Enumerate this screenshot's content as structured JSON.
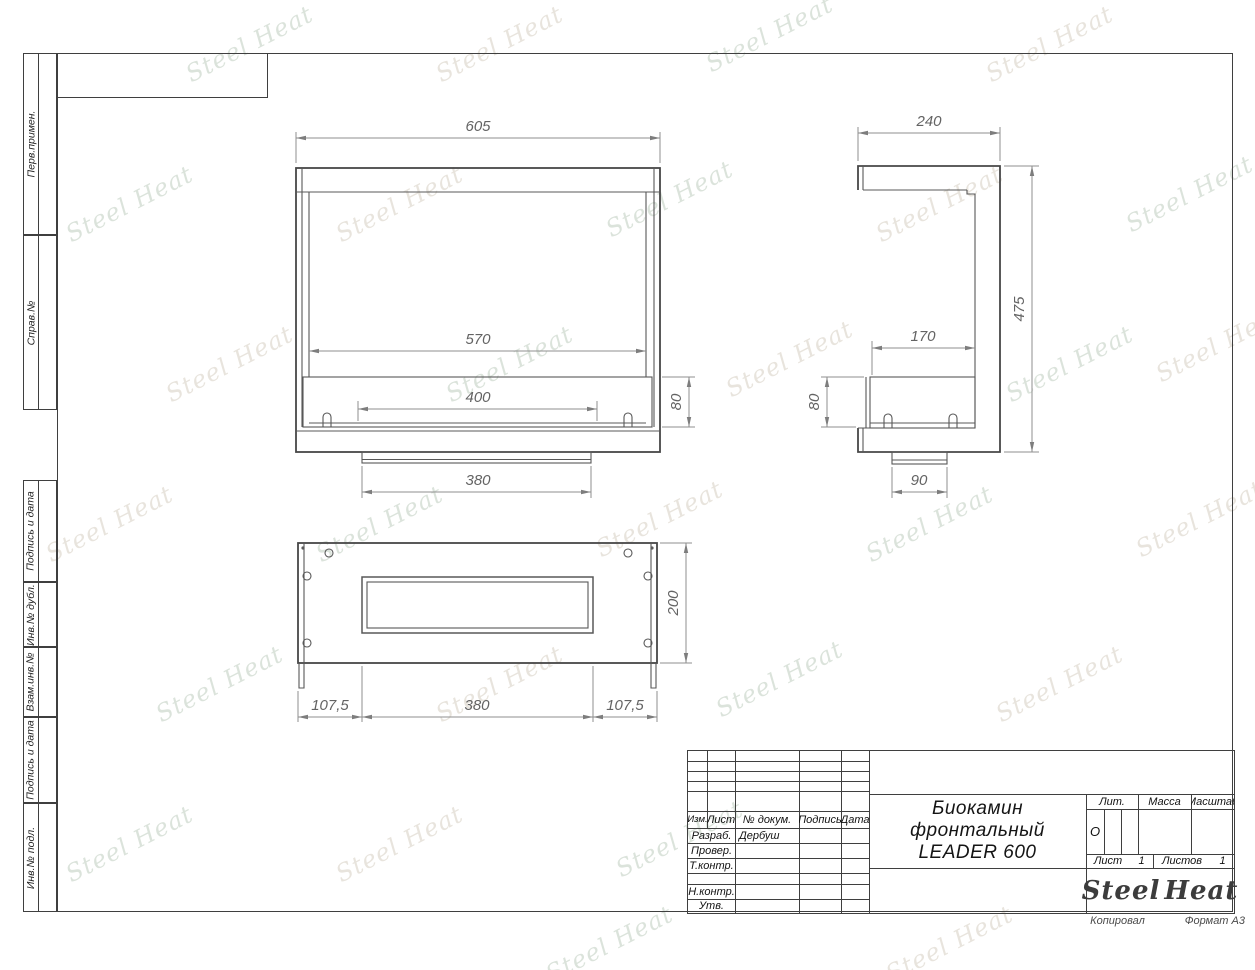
{
  "watermark": {
    "text": "Steel Heat"
  },
  "side_strip": {
    "boxes": [
      {
        "label": "Перв.примен."
      },
      {
        "label": "Справ.№"
      },
      {
        "label": "Подпись и дата"
      },
      {
        "label": "Инв.№ дубл."
      },
      {
        "label": "Взам.инв.№"
      },
      {
        "label": "Подпись и дата"
      },
      {
        "label": "Инв.№ подл."
      }
    ]
  },
  "drawing": {
    "front_view": {
      "dim_width": "605",
      "dim_glass_width": "570",
      "dim_burner_width": "400",
      "dim_burner_height": "80",
      "dim_base_width": "380"
    },
    "side_view": {
      "dim_depth": "240",
      "dim_height": "475",
      "dim_burner_depth": "170",
      "dim_burner_height": "80",
      "dim_base_depth": "90"
    },
    "top_view": {
      "dim_depth": "200",
      "dim_left": "107,5",
      "dim_center": "380",
      "dim_right": "107,5"
    }
  },
  "title_block": {
    "header_cols": {
      "izm": "Изм.",
      "list": "Лист",
      "doc": "№ докум.",
      "sign": "Подпись",
      "date": "Дата"
    },
    "sig_rows": [
      {
        "label": "Разраб.",
        "value": "Дербуш"
      },
      {
        "label": "Провер.",
        "value": ""
      },
      {
        "label": "Т.контр.",
        "value": ""
      },
      {
        "label": "Н.контр.",
        "value": ""
      },
      {
        "label": "Утв.",
        "value": ""
      }
    ],
    "title_lines": [
      "Биокамин",
      "фронтальный",
      "LEADER 600"
    ],
    "lit": {
      "label": "Лит.",
      "value": "О"
    },
    "massa": {
      "label": "Масса",
      "value": ""
    },
    "masshtab": {
      "label": "Масштаб",
      "value": ""
    },
    "sheet": {
      "label": "Лист",
      "value": "1"
    },
    "sheets": {
      "label": "Листов",
      "value": "1"
    },
    "logo": {
      "steel": "Steel",
      "heat": "Heat",
      "flame_color": "#e02b1d"
    }
  },
  "footer": {
    "copied": "Копировал",
    "format": "Формат А3"
  }
}
